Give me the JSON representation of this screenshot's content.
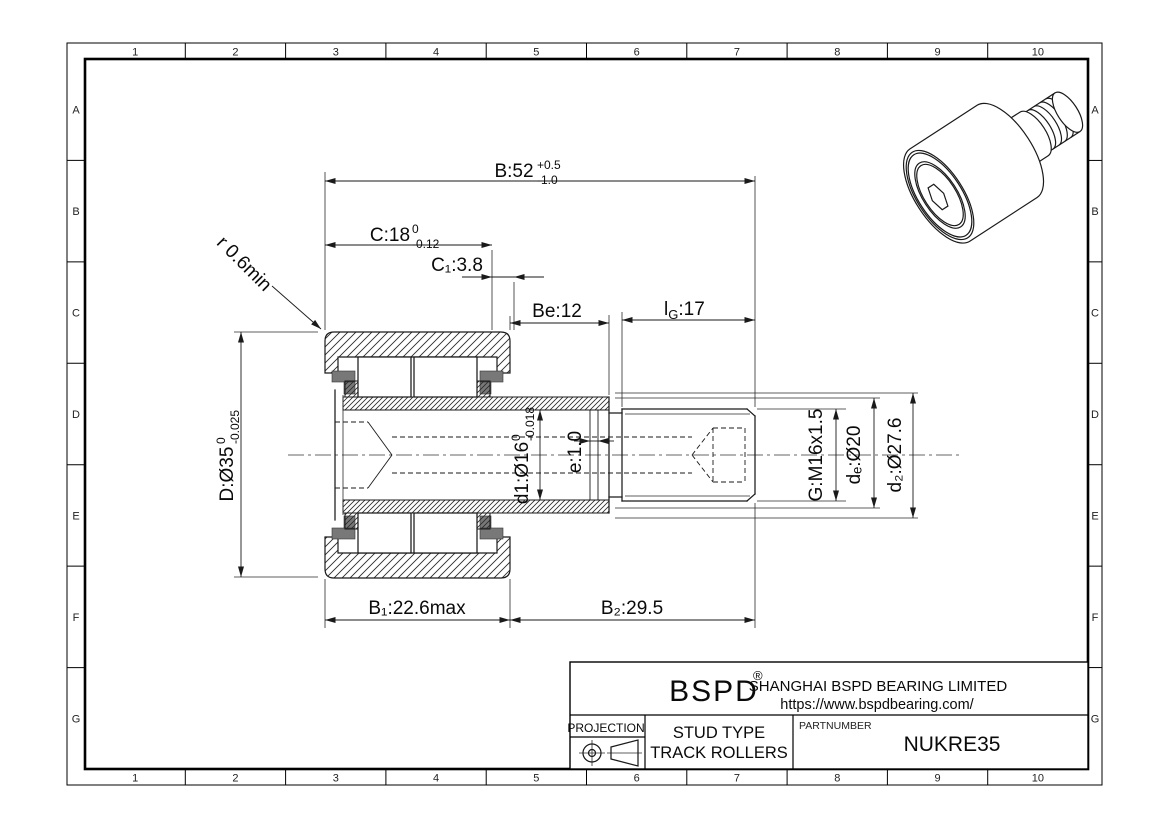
{
  "sheet": {
    "grid_columns": [
      "1",
      "2",
      "3",
      "4",
      "5",
      "6",
      "7",
      "8",
      "9",
      "10"
    ],
    "grid_rows": [
      "A",
      "B",
      "C",
      "D",
      "E",
      "F",
      "G"
    ]
  },
  "dimensions": {
    "B": {
      "main": "B:52",
      "tol_up": "+0.5",
      "tol_dn": "-1.0"
    },
    "C": {
      "main": "C:18",
      "tol_up": "0",
      "tol_dn": "-0.12"
    },
    "C1": {
      "main": "C₁:3.8"
    },
    "Be": {
      "main": "Be:12"
    },
    "lG": {
      "prefix": "l",
      "sub": "G",
      "rest": ":17"
    },
    "r": {
      "main": "r 0.6min"
    },
    "D": {
      "main": "D:Ø35",
      "tol_up": "0",
      "tol_dn": "-0.025"
    },
    "d1": {
      "main": "d1:Ø16",
      "tol_up": "0",
      "tol_dn": "-0.018"
    },
    "e": {
      "main": "e:1.0"
    },
    "G": {
      "main": "G:M16x1.5"
    },
    "de": {
      "main": "dₑ:Ø20"
    },
    "d2": {
      "main": "d₂:Ø27.6"
    },
    "B1": {
      "main": "B₁:22.6max"
    },
    "B2": {
      "main": "B₂:29.5"
    }
  },
  "title_block": {
    "logo": "BSPD",
    "logo_reg": "®",
    "company": "SHANGHAI BSPD BEARING LIMITED",
    "website": "https://www.bspdbearing.com/",
    "projection_label": "PROJECTION",
    "product_line1": "STUD TYPE",
    "product_line2": "TRACK ROLLERS",
    "partnumber_label": "PARTNUMBER",
    "partnumber": "NUKRE35"
  },
  "colors": {
    "line": "#1a1a1a",
    "background": "#ffffff",
    "seal": "#787878"
  }
}
